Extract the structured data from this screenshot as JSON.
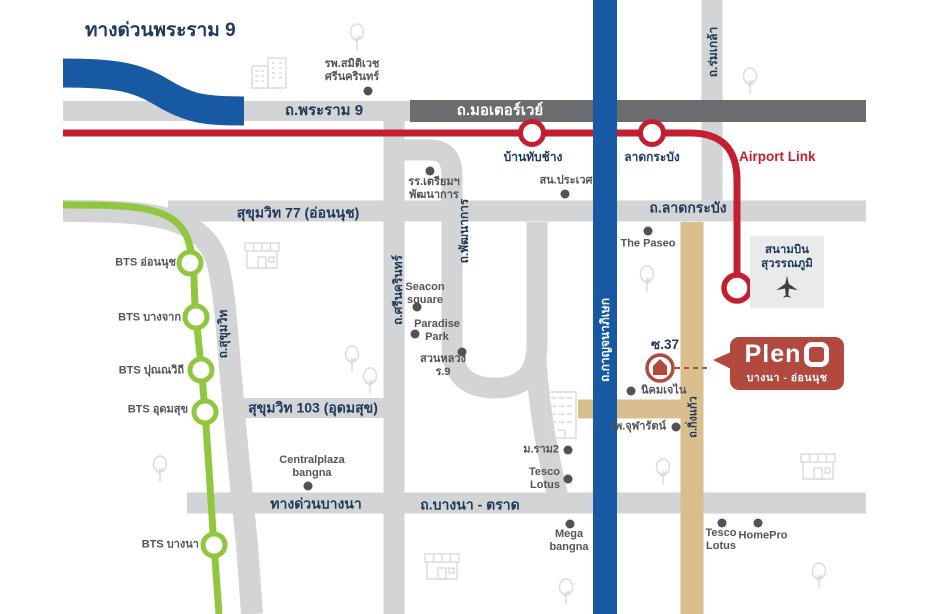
{
  "palette": {
    "navy": "#203a5c",
    "poi_gray": "#54555a",
    "road_gray": "#d2d4d5",
    "road_dark": "#6b6c70",
    "blue": "#1759a3",
    "red": "#c31f30",
    "green": "#90c73e",
    "tan": "#d8bf8d",
    "logo_red": "#b2493f",
    "icon_gray": "#d9dadb",
    "airport_box_bg": "#e9eaeb"
  },
  "title": "ทางด่วนพระราม 9",
  "roads": {
    "rama9": "ถ.พระราม 9",
    "motorway": "ถ.มอเตอร์เวย์",
    "romklao": "ถ.ร่มเกล้า",
    "ladkrabang": "ถ.ลาดกระบัง",
    "sukhumvit77": "สุขุมวิท 77 (อ่อนนุช)",
    "pattanakarn": "ถ.พัฒนาการ",
    "srinakarin": "ถ.ศรีนครินทร์",
    "sukhumvit": "ถ.สุขุมวิท",
    "sukhumvit103": "สุขุมวิท 103 (อุดมสุข)",
    "kanchanaphisek": "ถ.กาญจนาภิเษก",
    "kingkaew": "ถ.กิ่งแก้ว",
    "bangna_expressway": "ทางด่วนบางนา",
    "bangna_trad": "ถ.บางนา - ตราด"
  },
  "transit": {
    "airport_link_label": "Airport Link",
    "airport_link_stations": {
      "banthapchang": "บ้านทับช้าง",
      "ladkrabang": "ลาดกระบัง"
    },
    "bts_stations": {
      "onnut": "BTS อ่อนนุช",
      "bangchak": "BTS บางจาก",
      "punnawithi": "BTS ปุณณวิถี",
      "udomsuk": "BTS อุดมสุข",
      "bangna": "BTS บางนา"
    }
  },
  "airport": {
    "name": "สนามบิน\nสุวรรณภูมิ"
  },
  "pois": {
    "samitivej": "รพ.สมิติเวช\nศรีนครินทร์",
    "triam_pattanakarn": "รร.เตรียมฯ\nพัฒนาการ",
    "san_prawet": "สน.ประเวศ",
    "the_paseo": "The Paseo",
    "seacon_square": "Seacon\nsquare",
    "paradise_park": "Paradise\nPark",
    "suan_luang_r9": "สวนหลวง\nร.9",
    "nikhom": "นิคมเจไน",
    "chularat": "รพ.จุฬารัตน์",
    "centralplaza_bangna": "Centralplaza\nbangna",
    "m_ram2": "ม.ราม2",
    "tesco_lotus_north": "Tesco\nLotus",
    "mega_bangna": "Mega\nbangna",
    "tesco_lotus_south": "Tesco\nLotus",
    "homepro": "HomePro"
  },
  "project": {
    "name": "Pleno",
    "brand_prefix": "Plen",
    "subtitle": "บางนา - อ่อนนุช",
    "soi": "ซ.37"
  }
}
